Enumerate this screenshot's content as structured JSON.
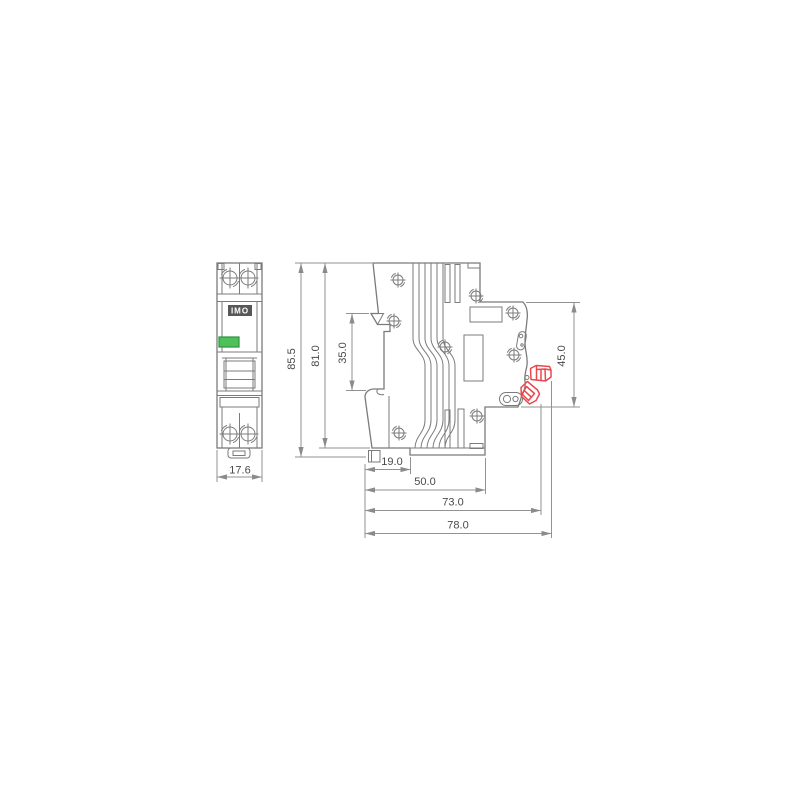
{
  "drawing": {
    "type": "technical-dimension-drawing",
    "subject": "miniature circuit breaker front and side views",
    "brand_label": "IMO",
    "dimensions": {
      "front_width_mm": "17.6",
      "overall_height_mm": "85.5",
      "body_height_mm": "81.0",
      "din_channel_mm": "35.0",
      "front_face_mm": "45.0",
      "clip_offset_mm": "19.0",
      "base_depth_mm": "50.0",
      "body_depth_mm": "73.0",
      "overall_depth_mm": "78.0"
    },
    "colors": {
      "line": "#7b7b7b",
      "dimension_line": "#929292",
      "text": "#4a4a4a",
      "accent_red": "#e8484e",
      "led_green": "#4ec15a",
      "led_green_border": "#2f9140",
      "label_bg": "#575757",
      "label_fg": "#ffffff",
      "background": "#ffffff"
    }
  }
}
